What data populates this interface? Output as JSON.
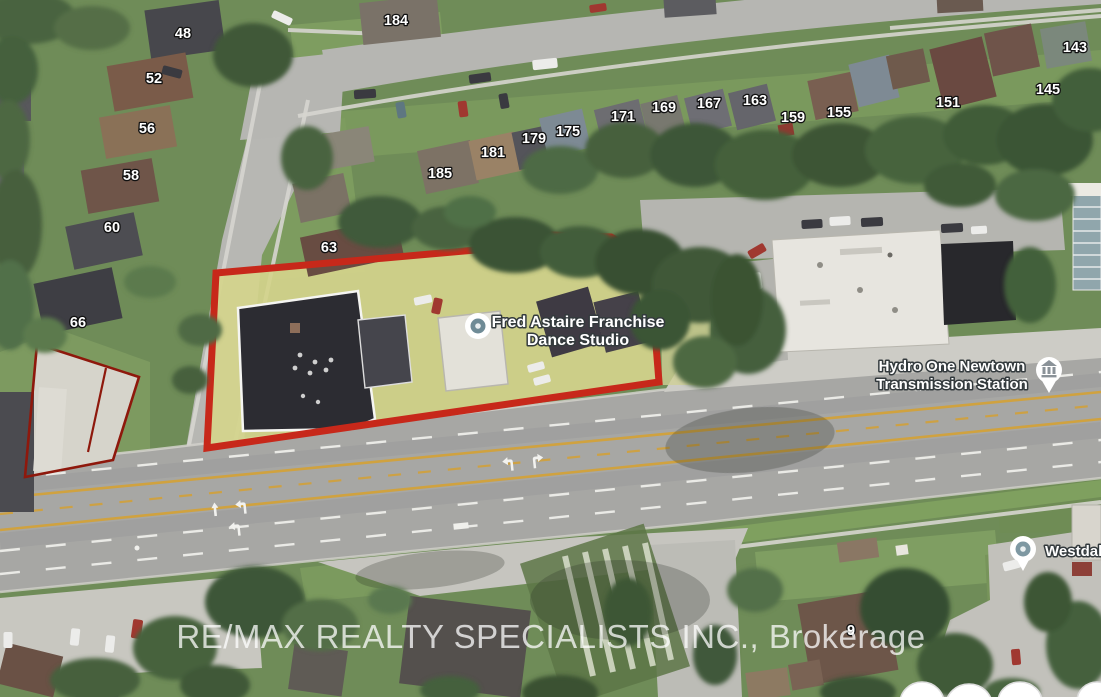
{
  "colors": {
    "subject_outline": "#c7281a",
    "secondary_outline": "#8e180c",
    "parking_highlight": "#d4d48c",
    "label_text": "#ffffff",
    "watermark_text": "#ffffff"
  },
  "watermark": {
    "text": "RE/MAX REALTY SPECIALISTS INC., Brokerage"
  },
  "pois": {
    "fred_astaire": {
      "line1": "Fred Astaire Franchise",
      "line2": "Dance Studio"
    },
    "hydro_one": {
      "line1": "Hydro One Newtown",
      "line2": "Transmission Station"
    },
    "westdale": {
      "text": "Westdale"
    }
  },
  "house_numbers": [
    {
      "value": "48"
    },
    {
      "value": "52"
    },
    {
      "value": "56"
    },
    {
      "value": "58"
    },
    {
      "value": "60"
    },
    {
      "value": "66"
    },
    {
      "value": "63"
    },
    {
      "value": "184"
    },
    {
      "value": "185"
    },
    {
      "value": "181"
    },
    {
      "value": "179"
    },
    {
      "value": "175"
    },
    {
      "value": "171"
    },
    {
      "value": "169"
    },
    {
      "value": "167"
    },
    {
      "value": "163"
    },
    {
      "value": "159"
    },
    {
      "value": "155"
    },
    {
      "value": "151"
    },
    {
      "value": "145"
    },
    {
      "value": "143"
    },
    {
      "value": "9"
    }
  ]
}
